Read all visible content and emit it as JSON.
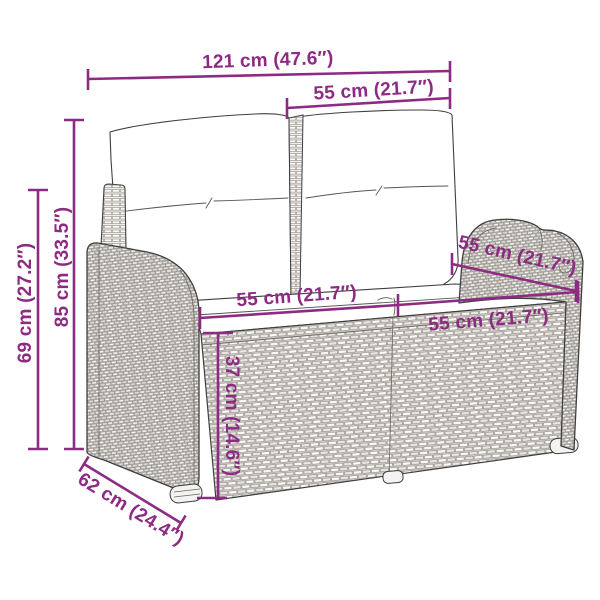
{
  "page": {
    "background": "#ffffff",
    "description": "Dimension diagram of a two-seater poly rattan garden bench with back and seat cushions"
  },
  "style": {
    "dimension_color": "#8d2a82",
    "line_art_color": "#3f3f3f",
    "wicker_fill": "#f1efec"
  },
  "dimensions": {
    "overall_width": {
      "label": "121 cm (47.6″)",
      "cm": 121,
      "inches": 47.6
    },
    "backrest_width": {
      "label": "55 cm (21.7″)",
      "cm": 55,
      "inches": 21.7
    },
    "overall_height": {
      "label": "85 cm (33.5″)",
      "cm": 85,
      "inches": 33.5
    },
    "armrest_height": {
      "label": "69 cm (27.2″)",
      "cm": 69,
      "inches": 27.2
    },
    "seat_width_left": {
      "label": "55 cm (21.7″)",
      "cm": 55,
      "inches": 21.7
    },
    "seat_width_right": {
      "label": "55 cm (21.7″)",
      "cm": 55,
      "inches": 21.7
    },
    "seat_depth": {
      "label": "55 cm (21.7″)",
      "cm": 55,
      "inches": 21.7
    },
    "seat_height": {
      "label": "37 cm (14.6″)",
      "cm": 37,
      "inches": 14.6
    },
    "overall_depth": {
      "label": "62 cm (24.4″)",
      "cm": 62,
      "inches": 24.4
    }
  }
}
